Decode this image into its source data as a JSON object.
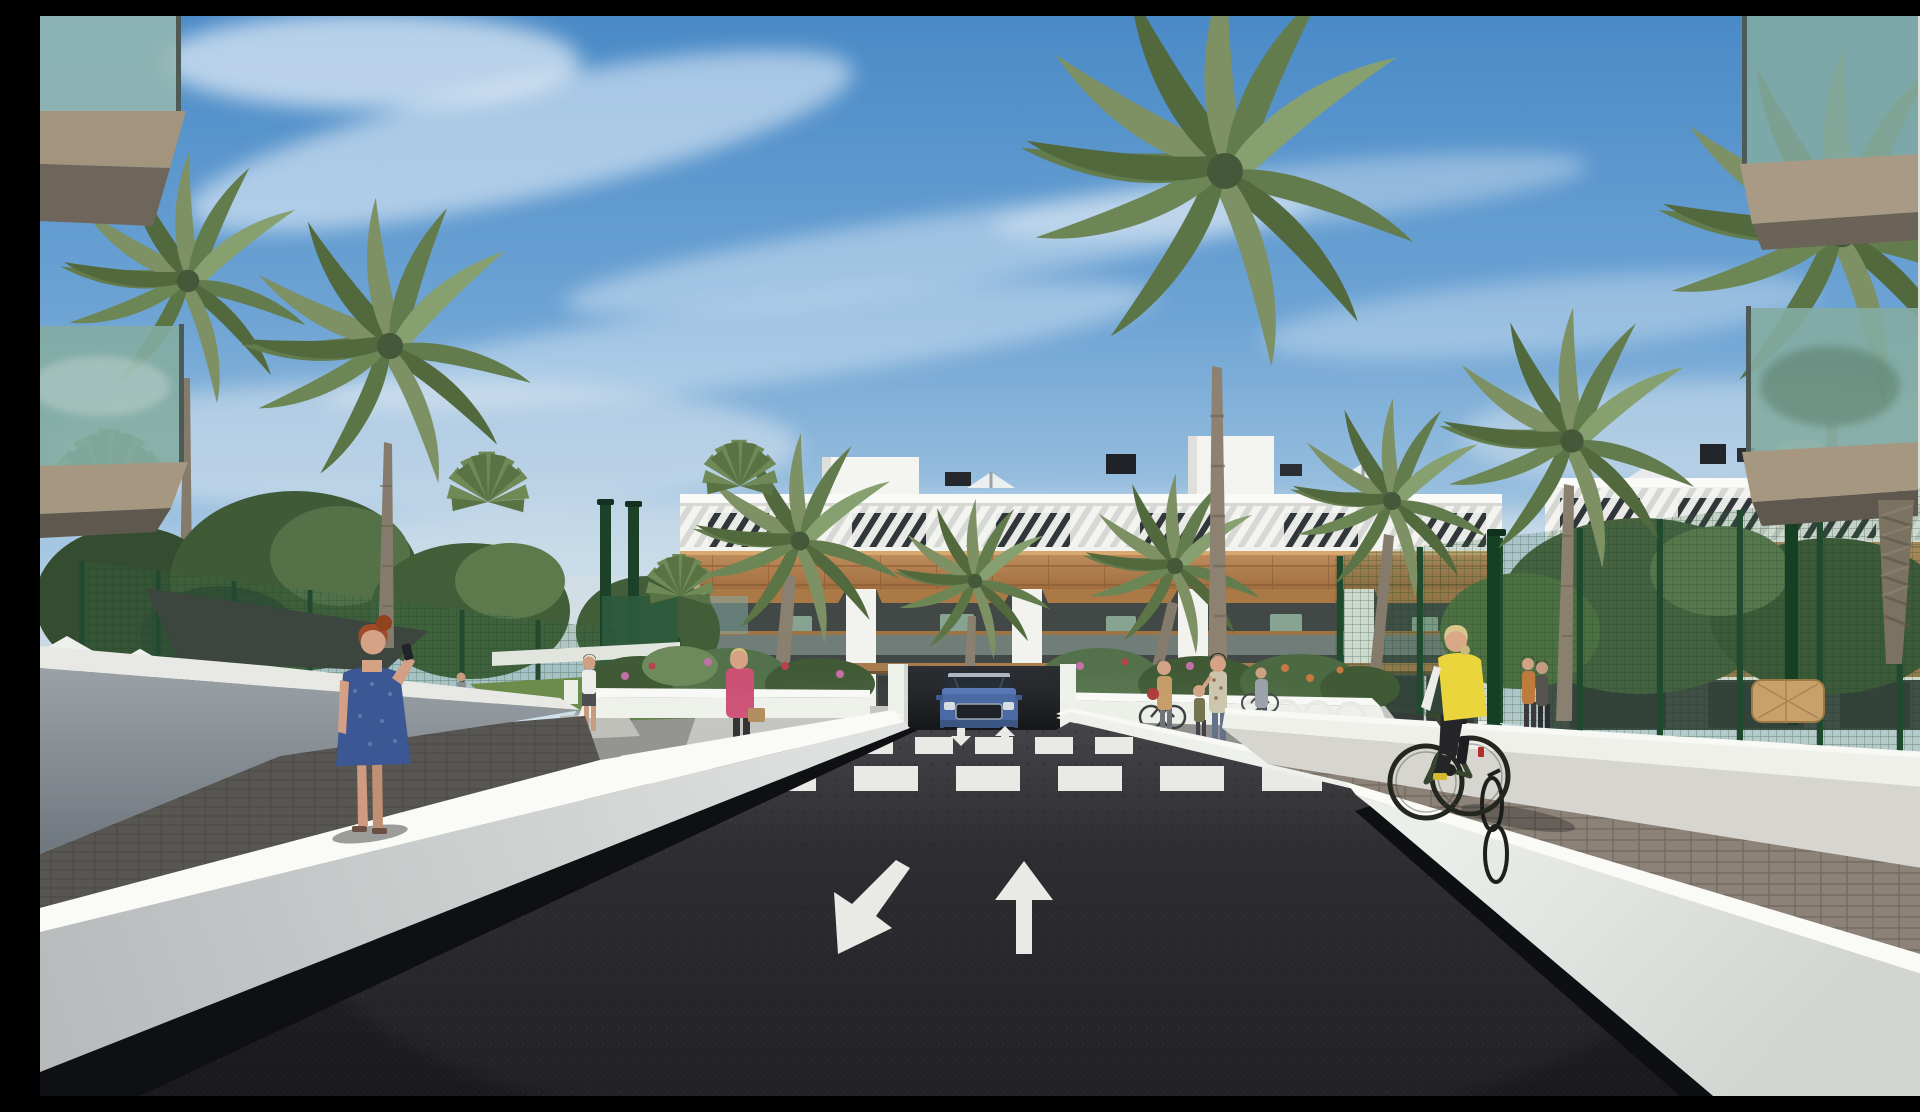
{
  "scene": {
    "type": "3d-architectural-render",
    "setting": "modern white residential apartment complex with palm trees, entrance road with zebra crossing, lane arrows and underground garage ramp, framed by foreground balconies",
    "sky": {
      "top": "#4a8ac7",
      "mid": "#9fc3e0",
      "horizon": "#e6ebee",
      "clouds": "wispy white cirrus streaks"
    },
    "buildings": {
      "center_block": {
        "floors": 3,
        "facade": "#f2f3ef",
        "wood_cladding": "#b5854f",
        "window_glass": "#2e3437",
        "roof_feature": "white slatted pergola band",
        "rooftop_items": [
          "stair bulkheads",
          "vent chimneys",
          "parasols"
        ]
      },
      "right_block": {
        "floors": 3,
        "facade": "#f1f2ee",
        "note": "seen through green mesh fence and palms"
      },
      "foreground_frames": {
        "left": "two cantilevered balconies with teal glass railings",
        "right": "two balconies with teal glass railings and white corner column",
        "slab_color": "#a3947e"
      }
    },
    "road": {
      "asphalt": "#232327",
      "marking_color": "#e9eae6",
      "lane_arrows": [
        {
          "direction": "down-left"
        },
        {
          "direction": "up"
        }
      ],
      "ramp_arrows": [
        {
          "direction": "down"
        },
        {
          "direction": "up"
        }
      ],
      "crosswalk": {
        "far_row_stripes": 6,
        "near_row_stripes": 7
      }
    },
    "walls": {
      "sunlit_white": "#eef0ec",
      "bright_cap": "#fafaf6",
      "shaded_gray": "#7e878e",
      "paver_strip": "#8d8277"
    },
    "fence": {
      "type": "green mesh security fence with gate posts",
      "color": "#2f5a40",
      "post_color": "#1f4430"
    },
    "vehicle": {
      "label": "blue SUV at underground garage ramp",
      "body": "#44639f",
      "windshield": "#1f2731"
    },
    "people": [
      {
        "label": "woman in blue dress talking on phone",
        "dress": "#3b5794",
        "hair": "#9c4a26"
      },
      {
        "label": "cyclist in yellow vest on green bike",
        "vest": "#ead63c",
        "bike": "#39462f"
      },
      {
        "label": "woman in pink jacket with tan bag",
        "jacket": "#cc4f74"
      },
      {
        "label": "person in gray by ramp wall"
      },
      {
        "label": "man in white t-shirt on garden path"
      },
      {
        "label": "visitor at garden gate"
      },
      {
        "label": "woman with bicycle and red bag"
      },
      {
        "label": "child with mother"
      },
      {
        "label": "mother in floral top"
      },
      {
        "label": "woman pushing bicycle at racks"
      },
      {
        "label": "two walkers on right garden path"
      },
      {
        "label": "man at pool area"
      },
      {
        "label": "couple on right-block balcony"
      }
    ],
    "vegetation": {
      "palm_trees": 12,
      "fan_palms": 4,
      "canopy_trees": 6,
      "palm_green": "#7d9164",
      "flower_colors": [
        "#c470a8",
        "#b8424e",
        "#c87840"
      ]
    },
    "amenities": [
      "pool umbrellas",
      "shade sail",
      "wicker bench",
      "bicycle racks"
    ],
    "colors": {
      "building_white": "#f2f3ef",
      "wood": "#b5854f",
      "road": "#232327",
      "marking": "#e9eae6",
      "car_body": "#44639f",
      "vest_yellow": "#ead63c",
      "dress_blue": "#3b5794",
      "jacket_pink": "#cc4f74",
      "fence_green": "#2f5a40",
      "shade_sail": "#3c463f",
      "glass_teal": "#84aca2",
      "wicker": "#c8a06a",
      "lawn": "#5d7f3f",
      "paver": "#8d8277",
      "wall_cap": "#fafaf6"
    }
  }
}
